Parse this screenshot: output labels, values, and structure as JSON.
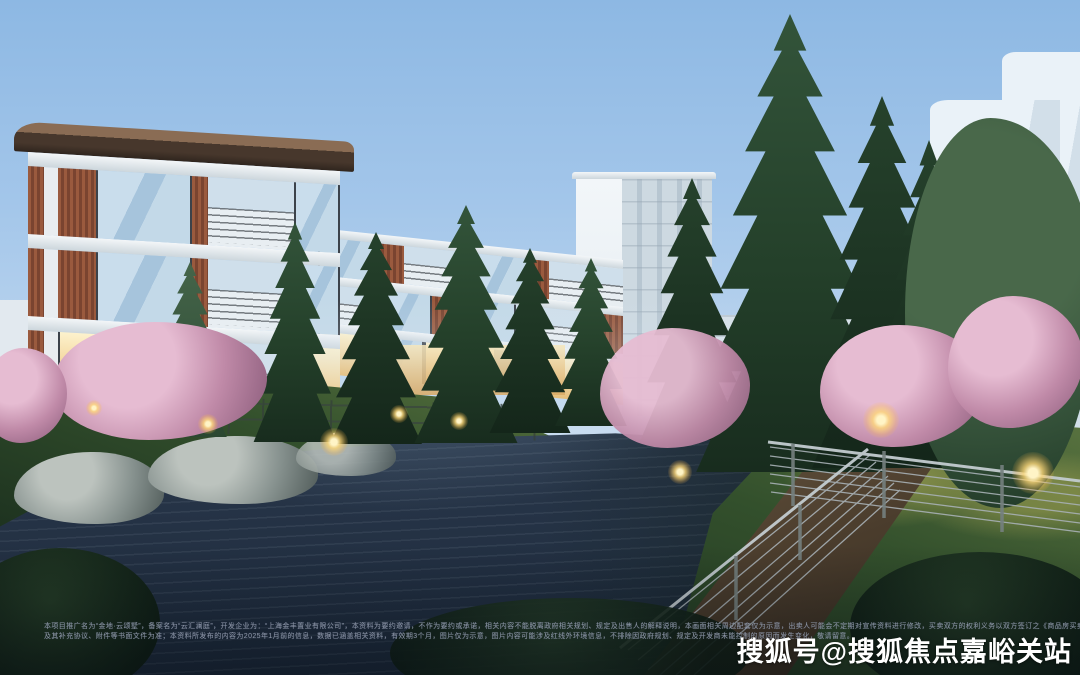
{
  "watermark": {
    "text": "搜狐号@搜狐焦点嘉峪关站"
  },
  "disclaimer": {
    "line1": "本项目推广名为“金地·云颂墅”，备案名为“云汇澜庭”，开发企业为：“上海金丰置业有限公司”，本资料为要约邀请，不作为要约或承诺，相关内容不能脱离政府相关规划、规定及出售人的解释说明，本画面相关周边配套仅为示意，出卖人可能会不定期对宣传资料进行修改，买卖双方的权利义务以双方签订之《商品房买卖合同》",
    "line2": "及其补充协议、附件等书面文件为准；本资料所发布的内容为2025年1月前的信息，数据已涵盖相关资料，有效期3个月，图片仅为示意，图片内容可能涉及红线外环境信息，不排除因政府规划、规定及开发商未能控制的原因而发生变化，敬请留意。"
  },
  "palette": {
    "sky_top": "#8db8e3",
    "sky_horizon": "#dfe9f3",
    "water_dark": "#1d2a3c",
    "foliage_dark": "#182c1e",
    "blossom_pink": "#c08aa8",
    "facade_white": "#f2f6f9",
    "facade_terracotta": "#8a4f37",
    "window_lit": "#f2d49a",
    "watermark_color": "#ffffff"
  }
}
